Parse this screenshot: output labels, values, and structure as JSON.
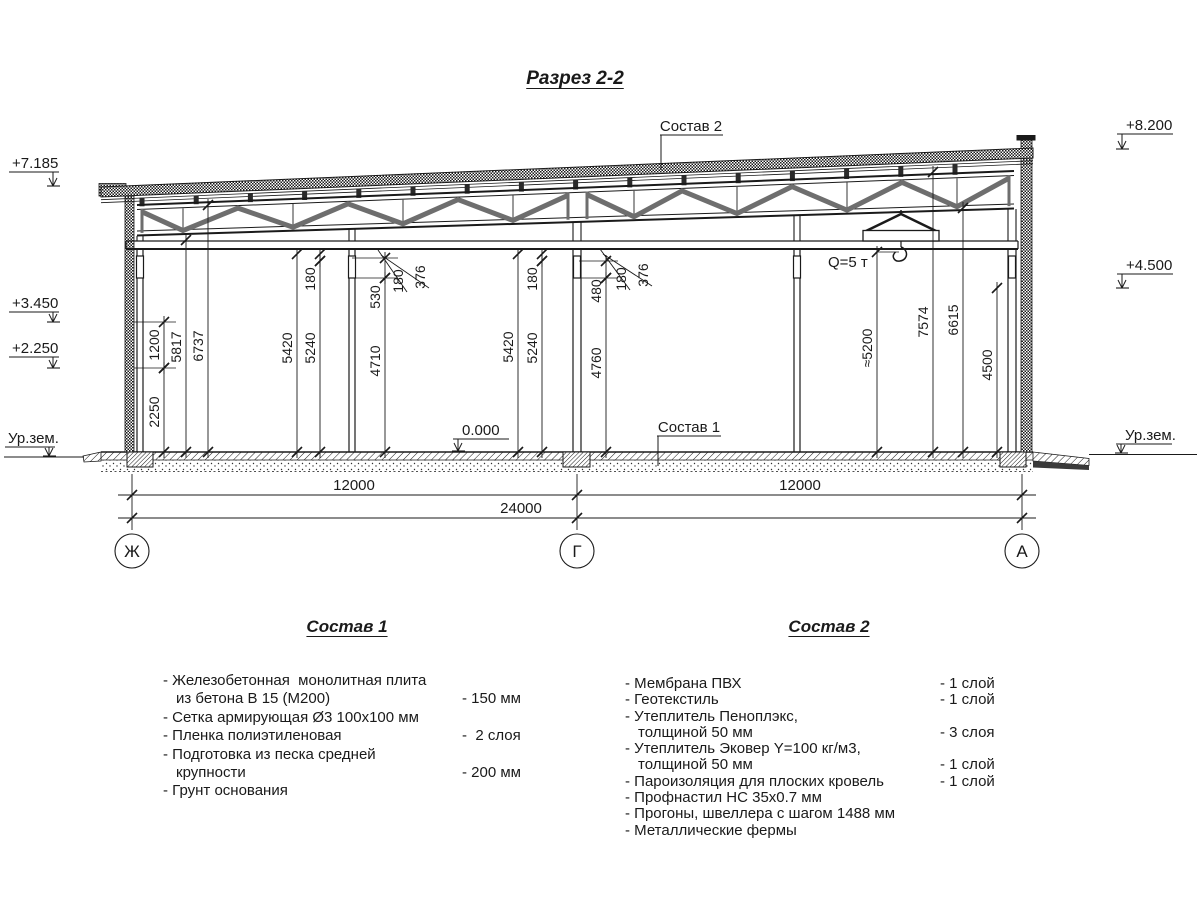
{
  "title": "Разрез 2-2",
  "section": {
    "labels": {
      "composition2_callout": "Состав 2",
      "composition1_callout": "Состав 1",
      "crane_capacity": "Q=5 т",
      "zero_level": "0.000"
    },
    "elevation_marks": [
      {
        "text": "+7.185",
        "side": "left",
        "x": 12,
        "y": 168,
        "tip": 186
      },
      {
        "text": "+3.450",
        "side": "left",
        "x": 12,
        "y": 308,
        "tip": 322
      },
      {
        "text": "+2.250",
        "side": "left",
        "x": 12,
        "y": 353,
        "tip": 368
      },
      {
        "text": "+8.200",
        "side": "right",
        "x": 1126,
        "y": 130,
        "tip": 149
      },
      {
        "text": "+4.500",
        "side": "right",
        "x": 1126,
        "y": 270,
        "tip": 288
      }
    ],
    "ground_marks": [
      {
        "text": "Ур.зем.",
        "side": "left",
        "x": 8,
        "y": 443,
        "tip": 456
      },
      {
        "text": "Ур.зем.",
        "side": "right",
        "x": 1125,
        "y": 440,
        "tip": 453
      }
    ],
    "vertical_dimensions": [
      {
        "label": "2250",
        "x": 164,
        "y1": 452,
        "y2": 368,
        "ty": 412
      },
      {
        "label": "1200",
        "x": 164,
        "y1": 368,
        "y2": 322,
        "ty": 345
      },
      {
        "label": "5817",
        "x": 186,
        "y1": 452,
        "y2": 240,
        "ty": 347
      },
      {
        "label": "6737",
        "x": 208,
        "y1": 452,
        "y2": 205,
        "ty": 346
      },
      {
        "label": "5420",
        "x": 297,
        "y1": 452,
        "y2": 254,
        "ty": 348
      },
      {
        "label": "5240",
        "x": 320,
        "y1": 452,
        "y2": 261,
        "ty": 348
      },
      {
        "label": "180",
        "x": 320,
        "y1": 261,
        "y2": 254,
        "ty": 279
      },
      {
        "label": "4710",
        "x": 385,
        "y1": 452,
        "y2": 278,
        "ty": 361
      },
      {
        "label": "530",
        "x": 385,
        "y1": 278,
        "y2": 258,
        "ty": 297
      },
      {
        "label": "5420",
        "x": 518,
        "y1": 452,
        "y2": 254,
        "ty": 347
      },
      {
        "label": "5240",
        "x": 542,
        "y1": 452,
        "y2": 261,
        "ty": 348
      },
      {
        "label": "180",
        "x": 542,
        "y1": 261,
        "y2": 254,
        "ty": 279
      },
      {
        "label": "4760",
        "x": 606,
        "y1": 452,
        "y2": 278,
        "ty": 363
      },
      {
        "label": "480",
        "x": 606,
        "y1": 278,
        "y2": 261,
        "ty": 291
      },
      {
        "label": "≈5200",
        "x": 877,
        "y1": 452,
        "y2": 252,
        "ty": 348
      },
      {
        "label": "7574",
        "x": 933,
        "y1": 452,
        "y2": 172,
        "ty": 322
      },
      {
        "label": "6615",
        "x": 963,
        "y1": 452,
        "y2": 208,
        "ty": 320
      },
      {
        "label": "4500",
        "x": 997,
        "y1": 452,
        "y2": 288,
        "ty": 365
      }
    ],
    "leader_dimensions": [
      {
        "label": "180",
        "tx": 403,
        "ty": 281,
        "x1": 407,
        "y1": 292,
        "x2": 378,
        "y2": 250
      },
      {
        "label": "376",
        "tx": 425,
        "ty": 277,
        "x1": 429,
        "y1": 288,
        "x2": 381,
        "y2": 255
      },
      {
        "label": "180",
        "tx": 626,
        "ty": 279,
        "x1": 630,
        "y1": 290,
        "x2": 600,
        "y2": 249
      },
      {
        "label": "376",
        "tx": 648,
        "ty": 275,
        "x1": 652,
        "y1": 286,
        "x2": 603,
        "y2": 254
      }
    ],
    "horizontal_dimensions": [
      {
        "label": "12000",
        "x": 354,
        "y": 495
      },
      {
        "label": "12000",
        "x": 800,
        "y": 495
      },
      {
        "label": "24000",
        "x": 521,
        "y": 518
      }
    ],
    "axes": [
      {
        "label": "Ж",
        "x": 132
      },
      {
        "label": "Г",
        "x": 577
      },
      {
        "label": "А",
        "x": 1022
      }
    ]
  },
  "composition1": {
    "title": "Состав 1",
    "items": [
      {
        "text": "- Железобетонная  монолитная плита",
        "value": ""
      },
      {
        "text": "из бетона В 15 (М200)",
        "value": "- 150 мм"
      },
      {
        "text": "- Сетка армирующая Ø3 100х100 мм",
        "value": ""
      },
      {
        "text": "- Пленка полиэтиленовая",
        "value": "-  2 слоя"
      },
      {
        "text": "- Подготовка из песка средней",
        "value": ""
      },
      {
        "text": "крупности",
        "value": "- 200 мм"
      },
      {
        "text": "- Грунт основания",
        "value": ""
      }
    ]
  },
  "composition2": {
    "title": "Состав 2",
    "items": [
      {
        "text": "- Мембрана ПВХ",
        "value": "- 1 слой"
      },
      {
        "text": "- Геотекстиль",
        "value": "- 1 слой"
      },
      {
        "text": "- Утеплитель Пеноплэкс,",
        "value": ""
      },
      {
        "text": "толщиной 50 мм",
        "value": "- 3 слоя"
      },
      {
        "text": "- Утеплитель Эковер Y=100 кг/м3,",
        "value": ""
      },
      {
        "text": "толщиной 50 мм",
        "value": "- 1 слой"
      },
      {
        "text": "- Пароизоляция для плоских кровель",
        "value": "- 1 слой"
      },
      {
        "text": "- Профнастил НС 35х0.7 мм",
        "value": ""
      },
      {
        "text": "- Прогоны, швеллера с шагом 1488 мм",
        "value": ""
      },
      {
        "text": "- Металлические фермы",
        "value": ""
      }
    ]
  }
}
